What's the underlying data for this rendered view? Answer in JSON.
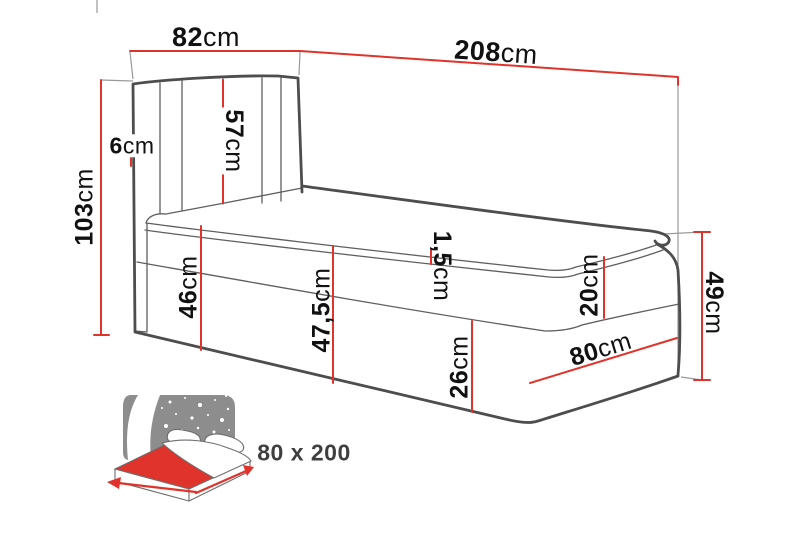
{
  "diagram": {
    "subject": "bed-with-headboard-dimension-drawing",
    "dimensions": {
      "headboard_width": {
        "num": "82",
        "unit": "cm"
      },
      "bed_length": {
        "num": "208",
        "unit": "cm"
      },
      "total_height": {
        "num": "103",
        "unit": "cm"
      },
      "headboard_panel_height": {
        "num": "57",
        "unit": "cm"
      },
      "headboard_thickness": {
        "num": "6",
        "unit": "cm"
      },
      "side_height_at_head": {
        "num": "46",
        "unit": "cm"
      },
      "side_height_mid": {
        "num": "47,5",
        "unit": "cm"
      },
      "topper_thickness": {
        "num": "1,5",
        "unit": "cm"
      },
      "mattress_height": {
        "num": "20",
        "unit": "cm"
      },
      "base_height": {
        "num": "26",
        "unit": "cm"
      },
      "foot_width": {
        "num": "80",
        "unit": "cm"
      },
      "foot_height": {
        "num": "49",
        "unit": "cm"
      }
    },
    "badge": {
      "size_label": "80 x 200"
    },
    "icons": [
      "night-sky-icon",
      "mattress-icon",
      "width-arrow-icon",
      "length-arrow-icon"
    ]
  },
  "colors": {
    "accent": "#e0332b",
    "outline": "#4d4d4d",
    "thin": "#5f5f5f",
    "ext": "#9a9a9a",
    "label": "#111111",
    "icon-gray": "#8d8d8d",
    "size-text": "#3f3f3f"
  }
}
